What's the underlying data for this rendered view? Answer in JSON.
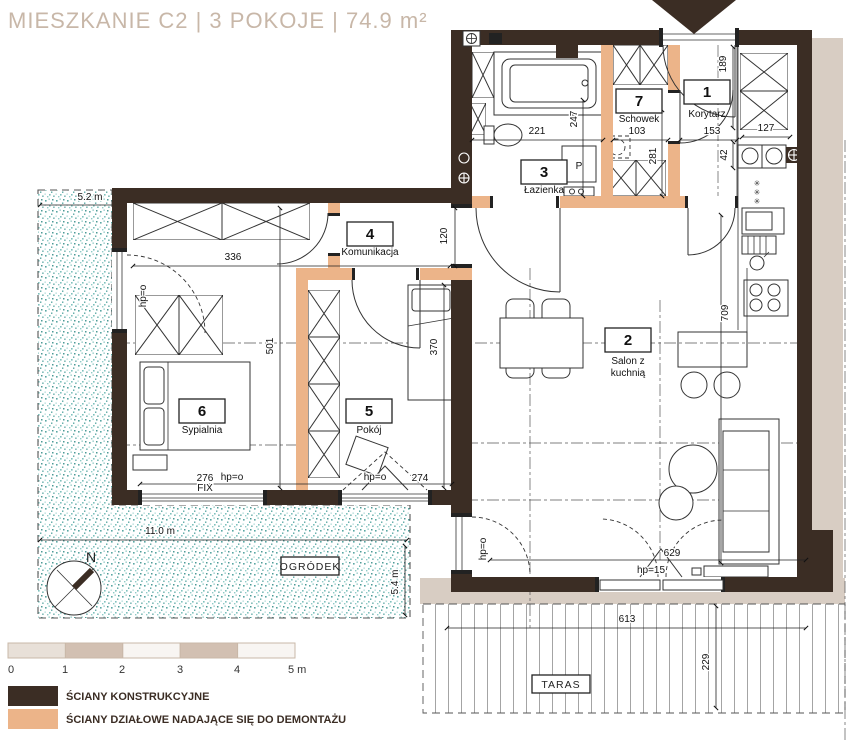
{
  "title": {
    "text": "MIESZKANIE C2  |  3 POKOJE  |  74.9 m²"
  },
  "rooms": {
    "korytarz": {
      "number": "1",
      "name": "Korytarz"
    },
    "salon": {
      "number": "2",
      "name_lines": [
        "Salon z",
        "kuchnią"
      ]
    },
    "lazienka": {
      "number": "3",
      "name": "Łazienka"
    },
    "komunikacja": {
      "number": "4",
      "name": "Komunikacja"
    },
    "pokoj": {
      "number": "5",
      "name": "Pokój"
    },
    "sypialnia": {
      "number": "6",
      "name": "Sypialnia"
    },
    "schowek": {
      "number": "7",
      "name": "Schowek"
    }
  },
  "dims": {
    "bedroom_width": "336",
    "komunikacja_height": "120",
    "bedroom_depth": "501",
    "pokoj_depth": "370",
    "fix_window_width": "276",
    "fix_label": "FIX",
    "balcony_door_width": "274",
    "hp_zero": "hp=o",
    "hp_15": "hp=15",
    "bath_width": "221",
    "bath_depth": "247",
    "schowek_width": "103",
    "korytarz_width": "153",
    "kitchen_width": "127",
    "cabinet_depth": "42",
    "korytarz_depth": "189",
    "schowek_depth": "281",
    "salon_depth": "709",
    "salon_window_width": "629",
    "terrace_width": "613",
    "terrace_depth": "229",
    "garden_width_top": "5.2 m",
    "garden_width_bottom": "11.0 m",
    "garden_depth": "5.4 m"
  },
  "labels": {
    "garden": "OGRÓDEK",
    "terrace": "TARAS",
    "washing_machine": "P",
    "north": "N",
    "freezer_star": "✳"
  },
  "scale_bar": {
    "ticks": [
      "0",
      "1",
      "2",
      "3",
      "4",
      "5 m"
    ]
  },
  "legend": {
    "structural_label": "ŚCIANY KONSTRUKCYJNE",
    "partition_label": "ŚCIANY DZIAŁOWE NADAJĄCE SIĘ DO DEMONTAŻU"
  },
  "colors": {
    "structural_wall": "#3b2d24",
    "partition_wall": "#ecb489",
    "exterior_band": "#d8cdc3",
    "garden_stipple": "#5aa7a3",
    "title": "#c8b7a8"
  }
}
